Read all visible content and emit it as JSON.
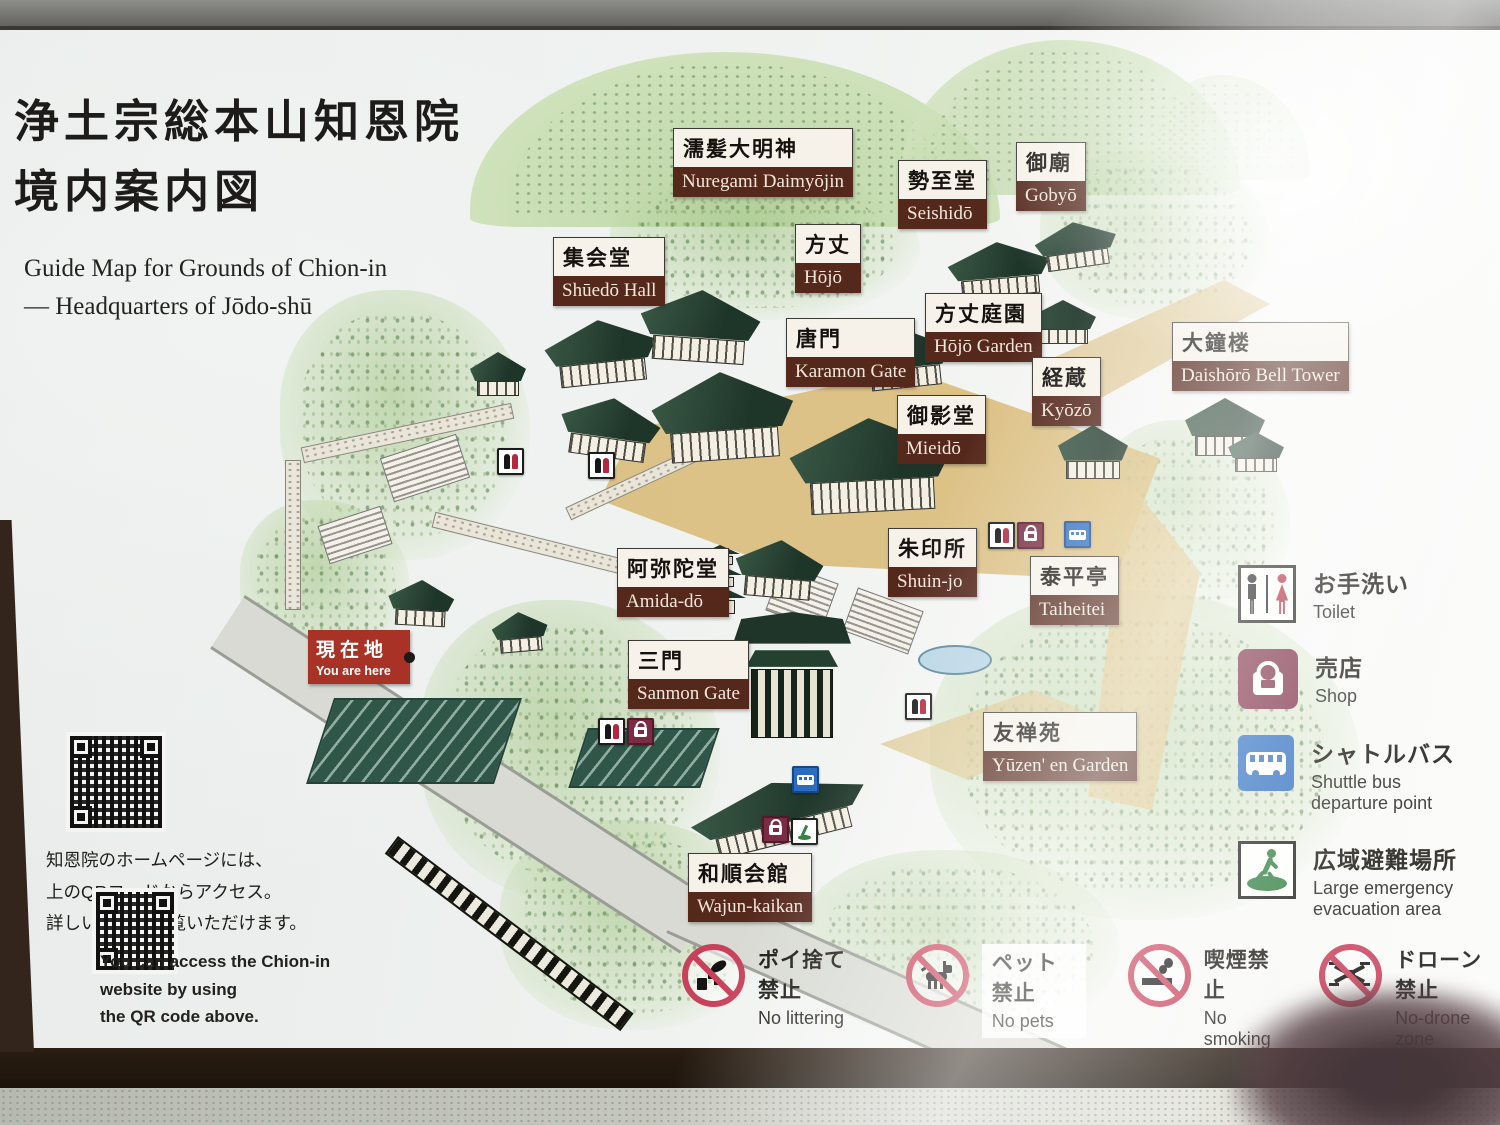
{
  "sign": {
    "title_jp": "浄土宗総本山知恩院\n境内案内図",
    "subtitle_en": "Guide Map for Grounds of Chion-in\n— Headquarters of Jōdo-shū"
  },
  "map": {
    "you_are_here": {
      "jp": "現在地",
      "en": "You are here"
    },
    "labels": [
      {
        "jp": "濡髪大明神",
        "en": "Nuregami Daimyōjin"
      },
      {
        "jp": "勢至堂",
        "en": "Seishidō"
      },
      {
        "jp": "御廟",
        "en": "Gobyō"
      },
      {
        "jp": "集会堂",
        "en": "Shūedō Hall"
      },
      {
        "jp": "方丈",
        "en": "Hōjō"
      },
      {
        "jp": "方丈庭園",
        "en": "Hōjō Garden"
      },
      {
        "jp": "唐門",
        "en": "Karamon Gate"
      },
      {
        "jp": "経蔵",
        "en": "Kyōzō"
      },
      {
        "jp": "大鐘楼",
        "en": "Daishōrō Bell Tower"
      },
      {
        "jp": "御影堂",
        "en": "Mieidō"
      },
      {
        "jp": "阿弥陀堂",
        "en": "Amida-dō"
      },
      {
        "jp": "朱印所",
        "en": "Shuin-jo"
      },
      {
        "jp": "泰平亭",
        "en": "Taiheitei"
      },
      {
        "jp": "三門",
        "en": "Sanmon Gate"
      },
      {
        "jp": "友禅苑",
        "en": "Yūzen' en Garden"
      },
      {
        "jp": "和順会館",
        "en": "Wajun-kaikan"
      }
    ]
  },
  "legend": [
    {
      "icon": "toilet-icon",
      "jp": "お手洗い",
      "en": "Toilet"
    },
    {
      "icon": "shop-icon",
      "jp": "売店",
      "en": "Shop"
    },
    {
      "icon": "shuttle-bus-icon",
      "jp": "シャトルバス",
      "en": "Shuttle bus\ndeparture point"
    },
    {
      "icon": "evacuation-icon",
      "jp": "広域避難場所",
      "en": "Large emergency\nevacuation area"
    }
  ],
  "notices": [
    {
      "icon": "no-littering-icon",
      "jp": "ポイ捨て禁止",
      "en": "No littering"
    },
    {
      "icon": "no-pets-icon",
      "jp": "ペット禁止",
      "en": "No pets"
    },
    {
      "icon": "no-smoking-icon",
      "jp": "喫煙禁止",
      "en": "No smoking"
    },
    {
      "icon": "no-drone-icon",
      "jp": "ドローン禁止",
      "en": "No-drone zone"
    }
  ],
  "qr": {
    "jp_note": "知恩院のホームページには、\n上のQRコードからアクセス。\n詳しい情報がご覧いただけます。",
    "en_note": "You can access the Chion-in\nwebsite by using\nthe QR code above."
  },
  "colors": {
    "label_maroon": "#55281c",
    "label_cream": "#f6f2e9",
    "you_are_here_red": "#a93226",
    "shop_maroon": "#7c2b44",
    "shuttle_bus_blue": "#2b6cc0",
    "evacuation_green": "#2e7d3e",
    "prohibition_red": "#c9405a"
  }
}
